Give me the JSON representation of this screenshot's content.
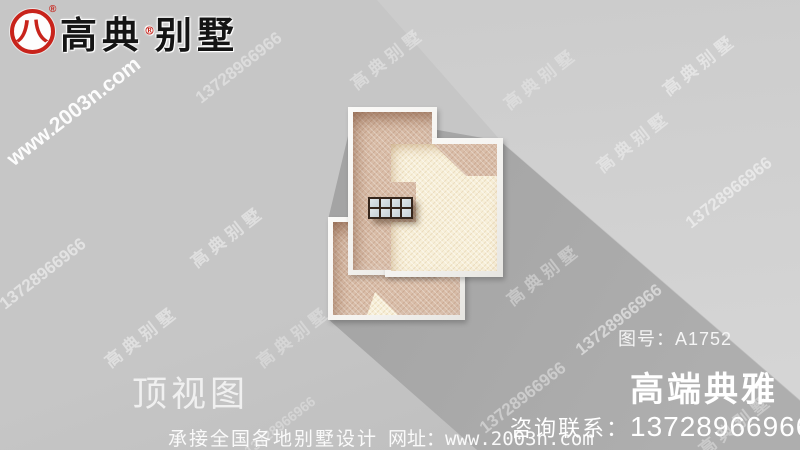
{
  "colors": {
    "bg": "#c6c6c6",
    "bg_dark": "#bcbcbc",
    "wedge_light": "#d5d5d5",
    "wedge_light2": "#cbcbcb",
    "shadow_dark": "#9d9d9d",
    "shadow_far": "#aeaeae",
    "red": "#c8231b",
    "ink": "#141414",
    "white": "#f5f5f5",
    "parapet": "#f3f2ef",
    "roof_tan": "#d9bda8",
    "roof_cream": "#f7efd8",
    "sky_frame": "#35261c",
    "sky_pane": "#ccd6db"
  },
  "brand": {
    "logo_glyph": "八",
    "reg": "®",
    "name_left": "高典",
    "name_right": "别墅"
  },
  "stamp": {
    "drawing_no": "图号：A1752"
  },
  "titles": {
    "view": "顶视图",
    "tagline": "高端典雅"
  },
  "footer": {
    "service": "承接全国各地别墅设计",
    "site": "网址：www.2003n.com",
    "contact_label": "咨询联系：",
    "phone": "13728966966"
  },
  "watermarks": [
    {
      "text": "www.2003n.com"
    },
    {
      "text": "13728966966"
    },
    {
      "text": "高典别墅"
    },
    {
      "text": "高典别墅"
    },
    {
      "text": "高典别墅"
    },
    {
      "text": "高典别墅"
    },
    {
      "text": "13728966966"
    },
    {
      "text": "13728966966"
    },
    {
      "text": "高典别墅"
    },
    {
      "text": "高典别墅"
    },
    {
      "text": "高典别墅"
    },
    {
      "text": "高典别墅"
    },
    {
      "text": "13728966966"
    },
    {
      "text": "13728966966"
    },
    {
      "text": "高典别墅"
    },
    {
      "text": "13728966966"
    }
  ]
}
